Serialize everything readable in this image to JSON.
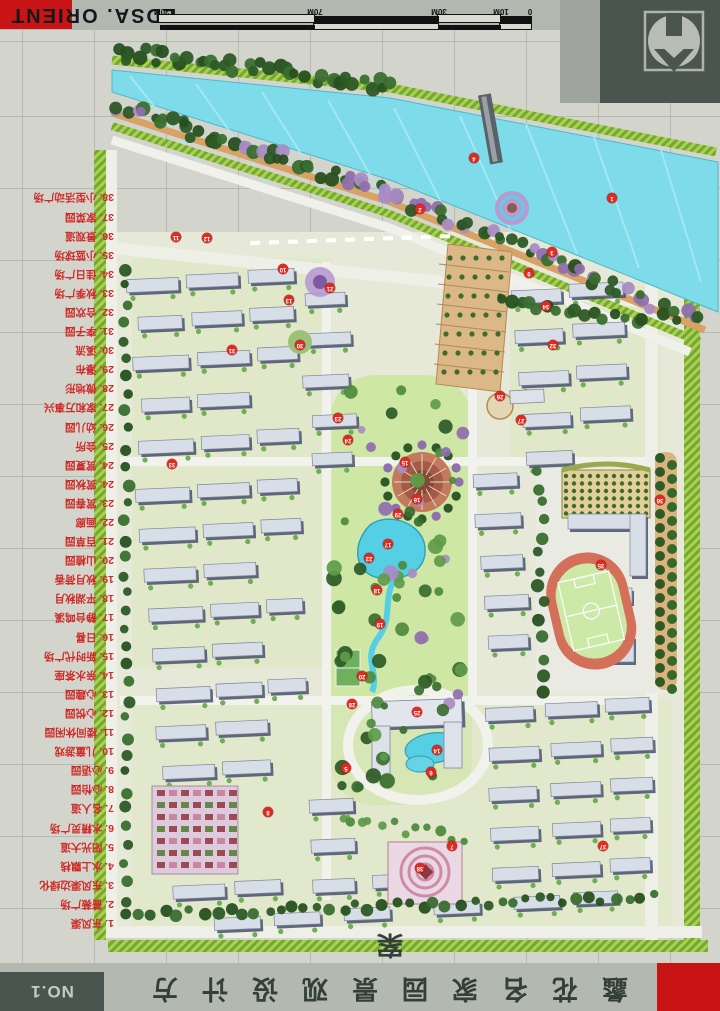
{
  "header": {
    "brand": "EDSA. ORIENT",
    "scale_bar": {
      "labels": [
        "0",
        "10M",
        "30M",
        "70M",
        "120M"
      ]
    }
  },
  "logo": {
    "name": "developer-emblem"
  },
  "legend": {
    "items": [
      "1. 东风渠",
      "2. 蔷薇广场",
      "3. 东风渠边绿化",
      "4. 水上飘栈",
      "5. 阳光大道",
      "6. 水精灵广场",
      "7. 名人道",
      "8. 心怡园",
      "9. 心语园",
      "10. 儿童游戏",
      "11. 楼间休闲园",
      "12. 心悦园",
      "13. 心趣园",
      "14. 亲水茶座",
      "15. 新时代广场",
      "16. 日晷",
      "17. 静台鸣溪",
      "18. 平湖秋月",
      "19. 秋月荷香",
      "20. 山楂园",
      "21. 百草园",
      "22. 画廊",
      "23. 赏春园",
      "24. 赏秋园",
      "24. 赏夏园",
      "25. 会所",
      "26. 幼儿园",
      "27. 家和万事兴",
      "28. 微地形",
      "29. 瀑布",
      "30. 溪流",
      "31. 李子园",
      "32. 合欢园",
      "33. 秋季广场",
      "34. 佳日广场",
      "35. 小篮球场",
      "36. 景观道",
      "37. 家菜园",
      "38. 小型活动广场"
    ]
  },
  "title_block": {
    "sheet_no": "NO.1",
    "title": "蠡花名家园景观设计方案"
  },
  "map_markers": [
    {
      "n": "1",
      "x": 612,
      "y": 198
    },
    {
      "n": "2",
      "x": 420,
      "y": 209
    },
    {
      "n": "3",
      "x": 552,
      "y": 252
    },
    {
      "n": "4",
      "x": 474,
      "y": 158
    },
    {
      "n": "5",
      "x": 346,
      "y": 768
    },
    {
      "n": "6",
      "x": 431,
      "y": 772
    },
    {
      "n": "7",
      "x": 452,
      "y": 846
    },
    {
      "n": "8",
      "x": 268,
      "y": 812
    },
    {
      "n": "9",
      "x": 529,
      "y": 273
    },
    {
      "n": "10",
      "x": 283,
      "y": 269
    },
    {
      "n": "11",
      "x": 176,
      "y": 237
    },
    {
      "n": "12",
      "x": 207,
      "y": 238
    },
    {
      "n": "13",
      "x": 289,
      "y": 300
    },
    {
      "n": "14",
      "x": 437,
      "y": 750
    },
    {
      "n": "15",
      "x": 405,
      "y": 462
    },
    {
      "n": "16",
      "x": 417,
      "y": 499
    },
    {
      "n": "17",
      "x": 388,
      "y": 544
    },
    {
      "n": "18",
      "x": 377,
      "y": 590
    },
    {
      "n": "19",
      "x": 380,
      "y": 624
    },
    {
      "n": "20",
      "x": 362,
      "y": 676
    },
    {
      "n": "21",
      "x": 330,
      "y": 288
    },
    {
      "n": "22",
      "x": 369,
      "y": 558
    },
    {
      "n": "23",
      "x": 338,
      "y": 418
    },
    {
      "n": "24",
      "x": 348,
      "y": 440
    },
    {
      "n": "25",
      "x": 417,
      "y": 712
    },
    {
      "n": "26",
      "x": 500,
      "y": 396
    },
    {
      "n": "27",
      "x": 521,
      "y": 420
    },
    {
      "n": "28",
      "x": 352,
      "y": 704
    },
    {
      "n": "29",
      "x": 398,
      "y": 514
    },
    {
      "n": "30",
      "x": 300,
      "y": 345
    },
    {
      "n": "31",
      "x": 232,
      "y": 350
    },
    {
      "n": "32",
      "x": 553,
      "y": 345
    },
    {
      "n": "33",
      "x": 172,
      "y": 464
    },
    {
      "n": "34",
      "x": 546,
      "y": 306
    },
    {
      "n": "35",
      "x": 601,
      "y": 565
    },
    {
      "n": "36",
      "x": 660,
      "y": 500
    },
    {
      "n": "37",
      "x": 603,
      "y": 846
    },
    {
      "n": "38",
      "x": 420,
      "y": 868
    }
  ],
  "colors": {
    "accent_red": "#c81414",
    "legend_red": "#cf2b28",
    "water": "#7edbe9",
    "dark_panel": "#4a5550",
    "track": "#d4705a"
  }
}
